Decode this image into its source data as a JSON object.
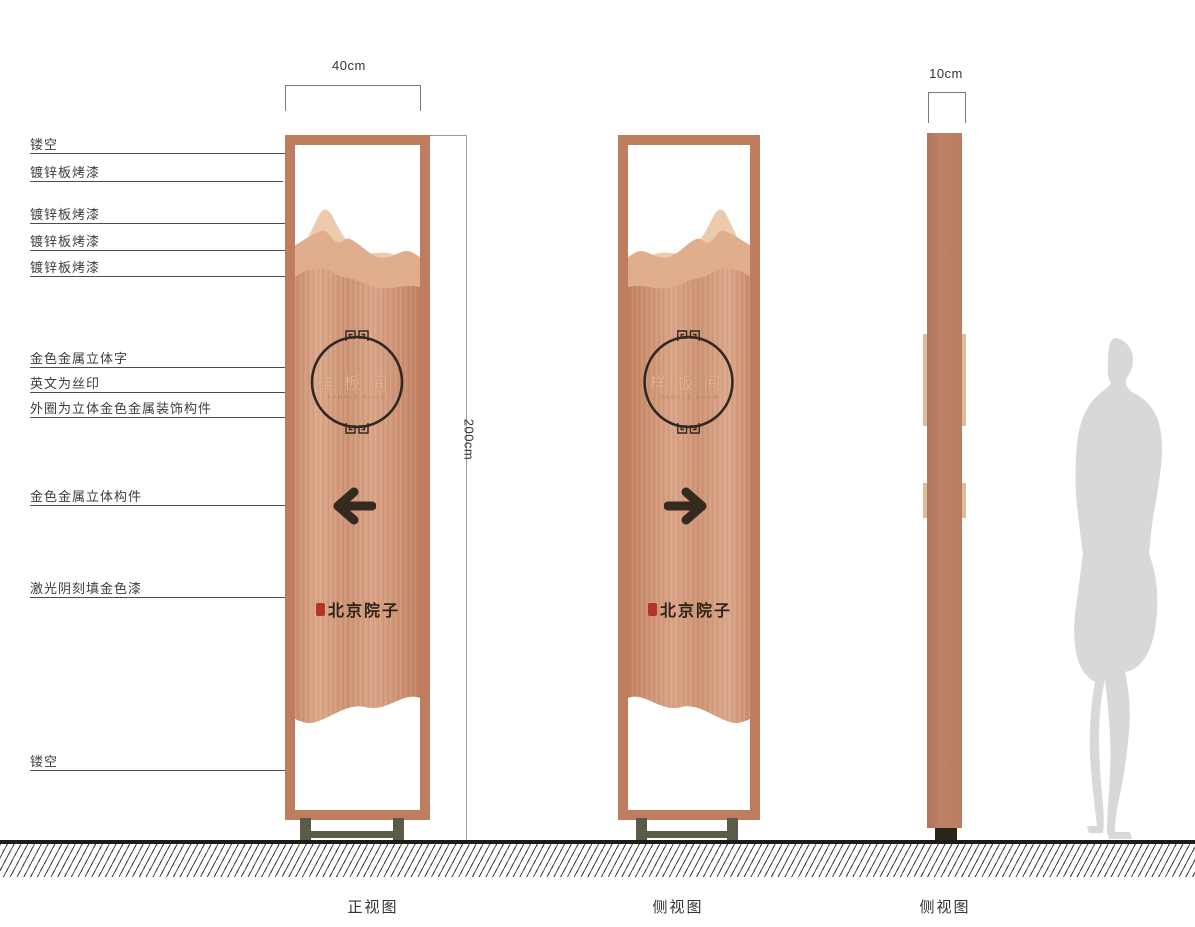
{
  "meta": {
    "doc_type": "signage-design-drawing"
  },
  "dimensions": {
    "front_width": "40cm",
    "height": "200cm",
    "side_width": "10cm"
  },
  "callouts": [
    {
      "label": "镂空"
    },
    {
      "label": "镀锌板烤漆"
    },
    {
      "label": "镀锌板烤漆"
    },
    {
      "label": "镀锌板烤漆"
    },
    {
      "label": "镀锌板烤漆"
    },
    {
      "label": "金色金属立体字"
    },
    {
      "label": "英文为丝印"
    },
    {
      "label": "外圈为立体金色金属装饰构件"
    },
    {
      "label": "金色金属立体构件"
    },
    {
      "label": "激光阴刻填金色漆"
    },
    {
      "label": "镂空"
    }
  ],
  "sign": {
    "circle_text": "样板间",
    "english_subtext": "SAMPLE ROOM",
    "brand_text": "北京院子"
  },
  "views": {
    "front": "正视图",
    "side": "侧视图",
    "profile": "侧视图"
  },
  "colors": {
    "frame": "#bf7d5f",
    "panel_light": "#dca88a",
    "panel_dark": "#c0815f",
    "mountain_back": "#eccaad",
    "mountain_mid": "#e0ad8d",
    "ink": "#342a1e",
    "gold_text": "#dcb392",
    "seal_red": "#b23527",
    "base": "#5c5b4a",
    "silhouette": "#d8d8d8"
  }
}
